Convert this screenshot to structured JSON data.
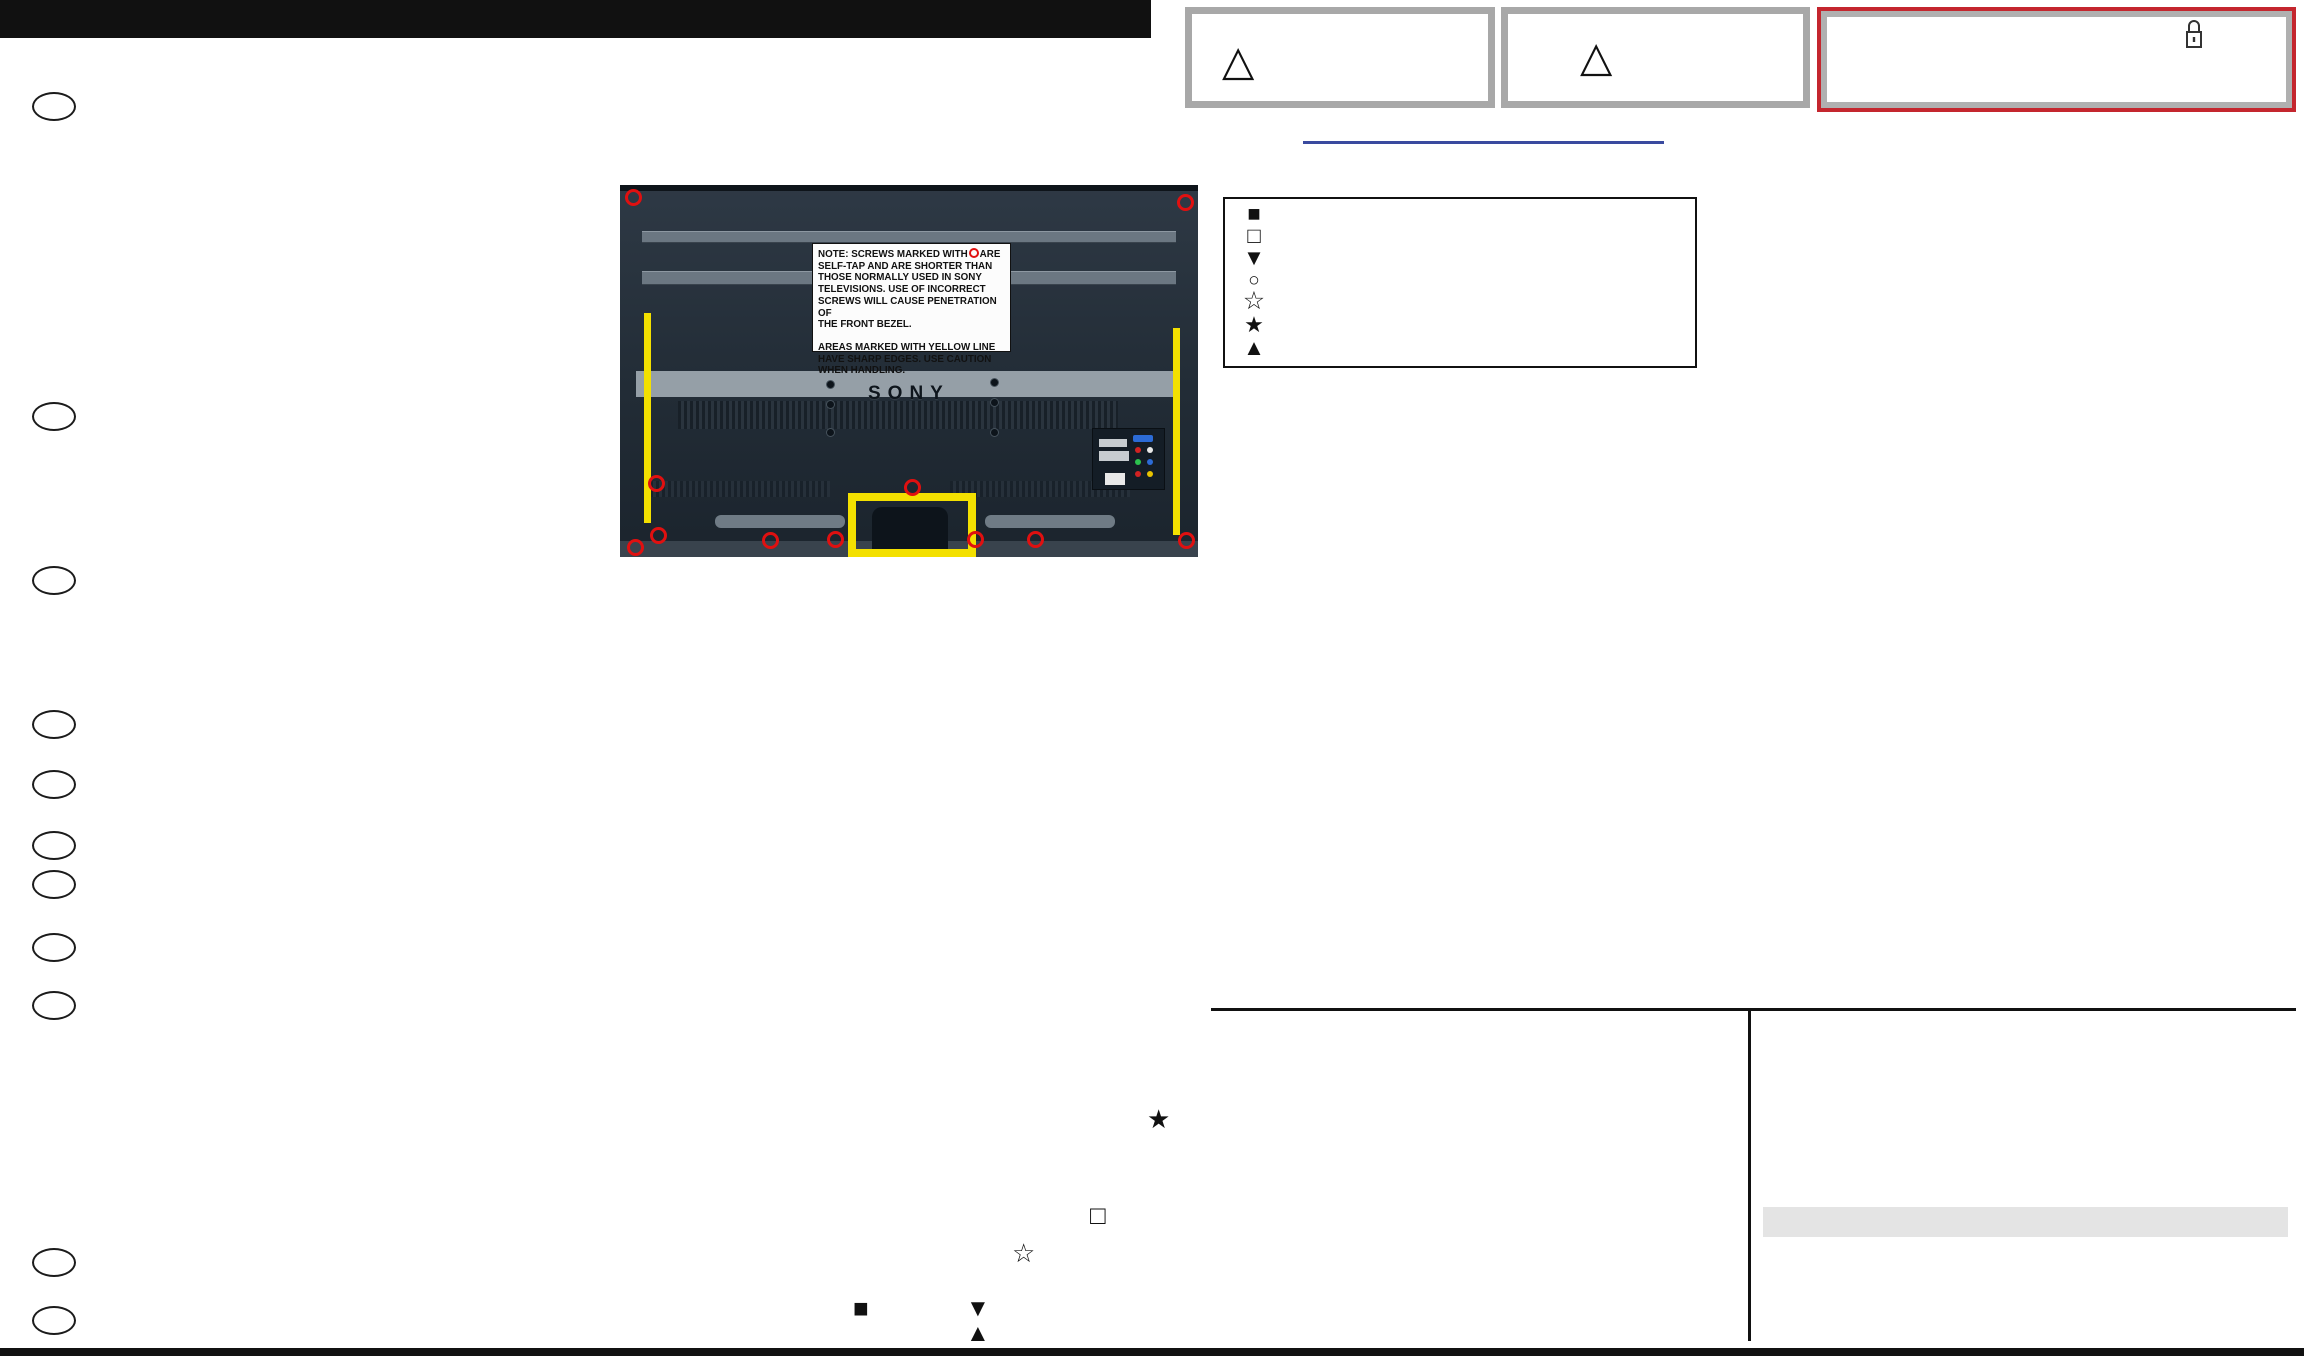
{
  "doc": {
    "kind": "service-manual-disassembly-page",
    "brand": "SONY"
  },
  "warning_boxes": {
    "box1": {
      "icon": "warning-triangle-icon",
      "glyph": "△"
    },
    "box2": {
      "icon": "warning-triangle-icon",
      "glyph": "△"
    },
    "box3": {
      "icon": "lock-icon",
      "border_color": "#c4262e"
    }
  },
  "link_line": {
    "color": "#3a4a9f"
  },
  "photo": {
    "brand": "SONY",
    "marker_color": "#e01010",
    "caution_color": "#f3e000",
    "note": {
      "line1_pre": "NOTE: SCREWS MARKED WITH",
      "line1_post": "ARE",
      "line2": "SELF-TAP AND ARE SHORTER THAN",
      "line3": "THOSE NORMALLY USED IN SONY",
      "line4": "TELEVISIONS. USE OF INCORRECT",
      "line5": "SCREWS WILL CAUSE PENETRATION OF",
      "line6": "THE FRONT BEZEL.",
      "line7": "AREAS MARKED WITH YELLOW LINE",
      "line8": "HAVE SHARP EDGES. USE CAUTION",
      "line9": "WHEN HANDLING."
    }
  },
  "legend": {
    "symbols": [
      "■",
      "□",
      "▼",
      "○",
      "☆",
      "★",
      "▲"
    ]
  },
  "screw_marks": {
    "filled_star": "★",
    "open_square": "□",
    "open_star": "☆",
    "filled_square": "■",
    "down_triangle": "▼",
    "up_triangle": "▲"
  },
  "colors": {
    "rear_cover": "#c3661c",
    "metal_bracket": "#c7d8d3",
    "purple_bracket": "#b795c6",
    "panel_green": "#4a8c3e",
    "bezel_blue": "#24344f",
    "accent_red": "#c4262e"
  }
}
